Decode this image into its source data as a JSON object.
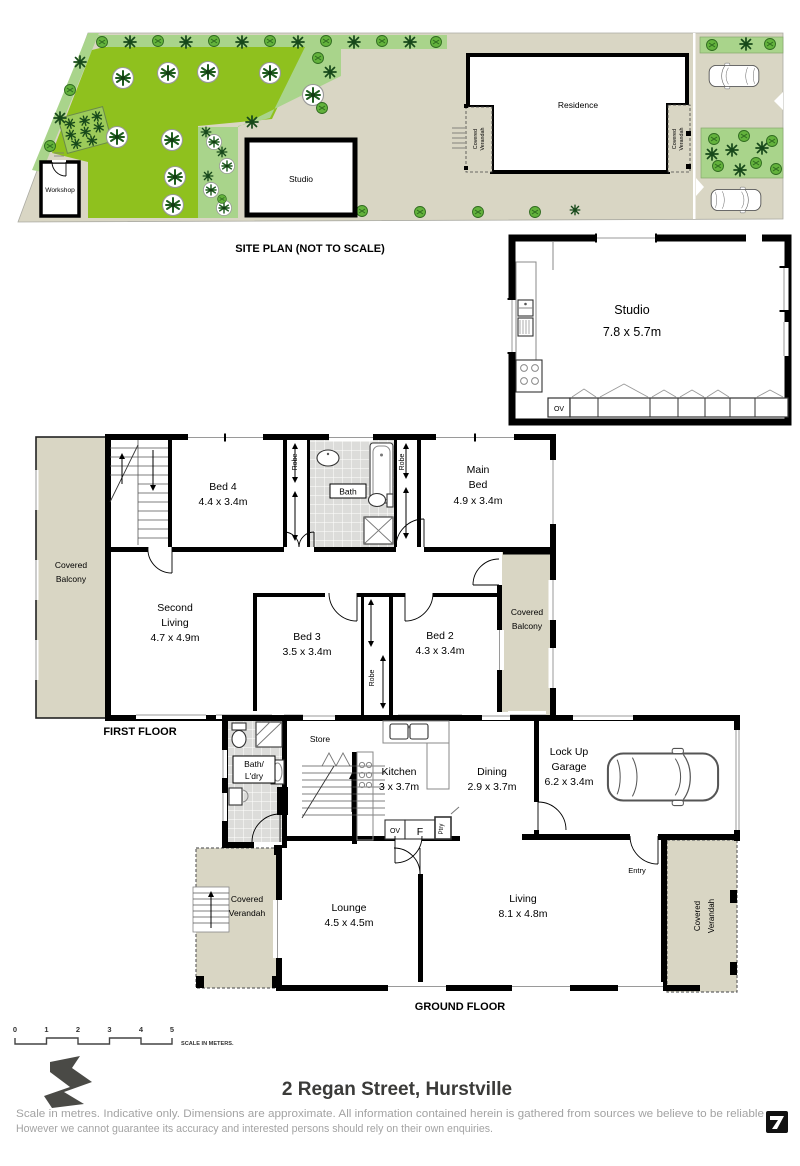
{
  "colors": {
    "lawn_green": "#8FC11E",
    "shrub_green": "#A9D48B",
    "plant_dark": "#1E5C1E",
    "paving_beige": "#D9D6C4",
    "tile_grey": "#DCDCDA",
    "wall_black": "#000000",
    "disclaimer_grey": "#A3A3A3",
    "logo_grey": "#4A4A46"
  },
  "site_plan": {
    "caption": "SITE PLAN (NOT TO SCALE)",
    "workshop": "Workshop",
    "studio": "Studio",
    "residence": "Residence",
    "verandah_left_line1": "Covered",
    "verandah_left_line2": "Verandah",
    "verandah_right_line1": "Covered",
    "verandah_right_line2": "Verandah"
  },
  "studio_plan": {
    "name": "Studio",
    "dims": "7.8 x 5.7m",
    "oven": "OV"
  },
  "first_floor": {
    "caption": "FIRST FLOOR",
    "balcony_left_line1": "Covered",
    "balcony_left_line2": "Balcony",
    "balcony_right_line1": "Covered",
    "balcony_right_line2": "Balcony",
    "bed4_name": "Bed 4",
    "bed4_dims": "4.4 x 3.4m",
    "bath": "Bath",
    "main_bed_line1": "Main",
    "main_bed_line2": "Bed",
    "main_bed_dims": "4.9 x 3.4m",
    "second_living_line1": "Second",
    "second_living_line2": "Living",
    "second_living_dims": "4.7 x 4.9m",
    "bed3_name": "Bed 3",
    "bed3_dims": "3.5 x 3.4m",
    "bed2_name": "Bed 2",
    "bed2_dims": "4.3 x 3.4m",
    "robe_left": "Robe",
    "robe_right": "Robe",
    "robe_lower": "Robe"
  },
  "ground_floor": {
    "caption": "GROUND FLOOR",
    "bath_line1": "Bath/",
    "bath_line2": "L'dry",
    "store": "Store",
    "kitchen_name": "Kitchen",
    "kitchen_dims": "3 x 3.7m",
    "dining_name": "Dining",
    "dining_dims": "2.9 x 3.7m",
    "garage_line1": "Lock Up",
    "garage_line2": "Garage",
    "garage_dims": "6.2 x 3.4m",
    "lounge_name": "Lounge",
    "lounge_dims": "4.5 x 4.5m",
    "living_name": "Living",
    "living_dims": "8.1 x 4.8m",
    "verandah_left_line1": "Covered",
    "verandah_left_line2": "Verandah",
    "verandah_right_line1": "Covered",
    "verandah_right_line2": "Verandah",
    "entry": "Entry",
    "oven": "OV",
    "fridge": "F",
    "pantry": "Ptry"
  },
  "footer": {
    "scale_ticks": [
      "0",
      "1",
      "2",
      "3",
      "4",
      "5"
    ],
    "scale_caption": "SCALE IN METERS.",
    "address": "2 Regan Street, Hurstville",
    "disclaimer_line1": "Scale in metres. Indicative only. Dimensions are approximate. All information contained herein is gathered from sources we believe to be reliable",
    "disclaimer_line2": "However we cannot guarantee its accuracy and interested persons should rely on their own enquiries."
  }
}
